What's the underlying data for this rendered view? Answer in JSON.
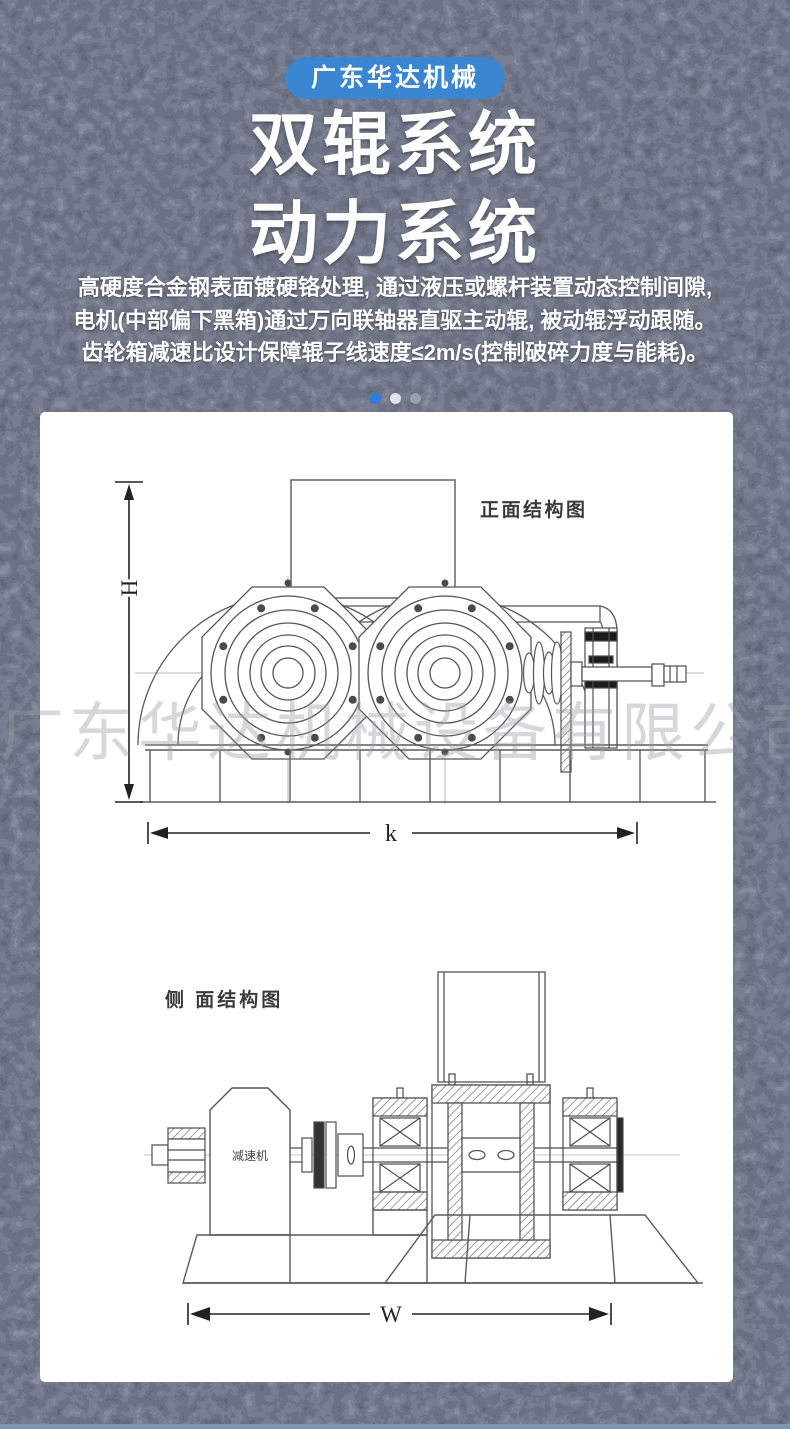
{
  "page": {
    "background_color": "#2b3243",
    "bottom_bar_color": "#7d96ae",
    "card_color": "#ffffff"
  },
  "header": {
    "badge_label": "广东华达机械",
    "badge_color": "#3b86d1",
    "title_lines": [
      "双辊系统",
      "动力系统"
    ],
    "description_lines": [
      "高硬度合金钢表面镀硬铬处理, 通过液压或螺杆装置动态控制间隙,",
      "电机(中部偏下黑箱)通过万向联轴器直驱主动辊, 被动辊浮动跟随。",
      "齿轮箱减速比设计保障辊子线速度≤2m/s(控制破碎力度与能耗)。"
    ]
  },
  "carousel": {
    "dots": [
      {
        "state": "active",
        "color": "#2b7de2"
      },
      {
        "state": "light",
        "color": "#e0e3e6"
      },
      {
        "state": "inactive",
        "color": "#9aa0a6"
      }
    ]
  },
  "diagrams": {
    "front_view": {
      "title": "正面结构图",
      "height_dim_label": "H",
      "width_dim_label": "k"
    },
    "side_view": {
      "title": "侧 面结构图",
      "reducer_label": "减速机",
      "width_dim_label": "W"
    }
  },
  "watermark": "广东华达机械设备有限公司"
}
